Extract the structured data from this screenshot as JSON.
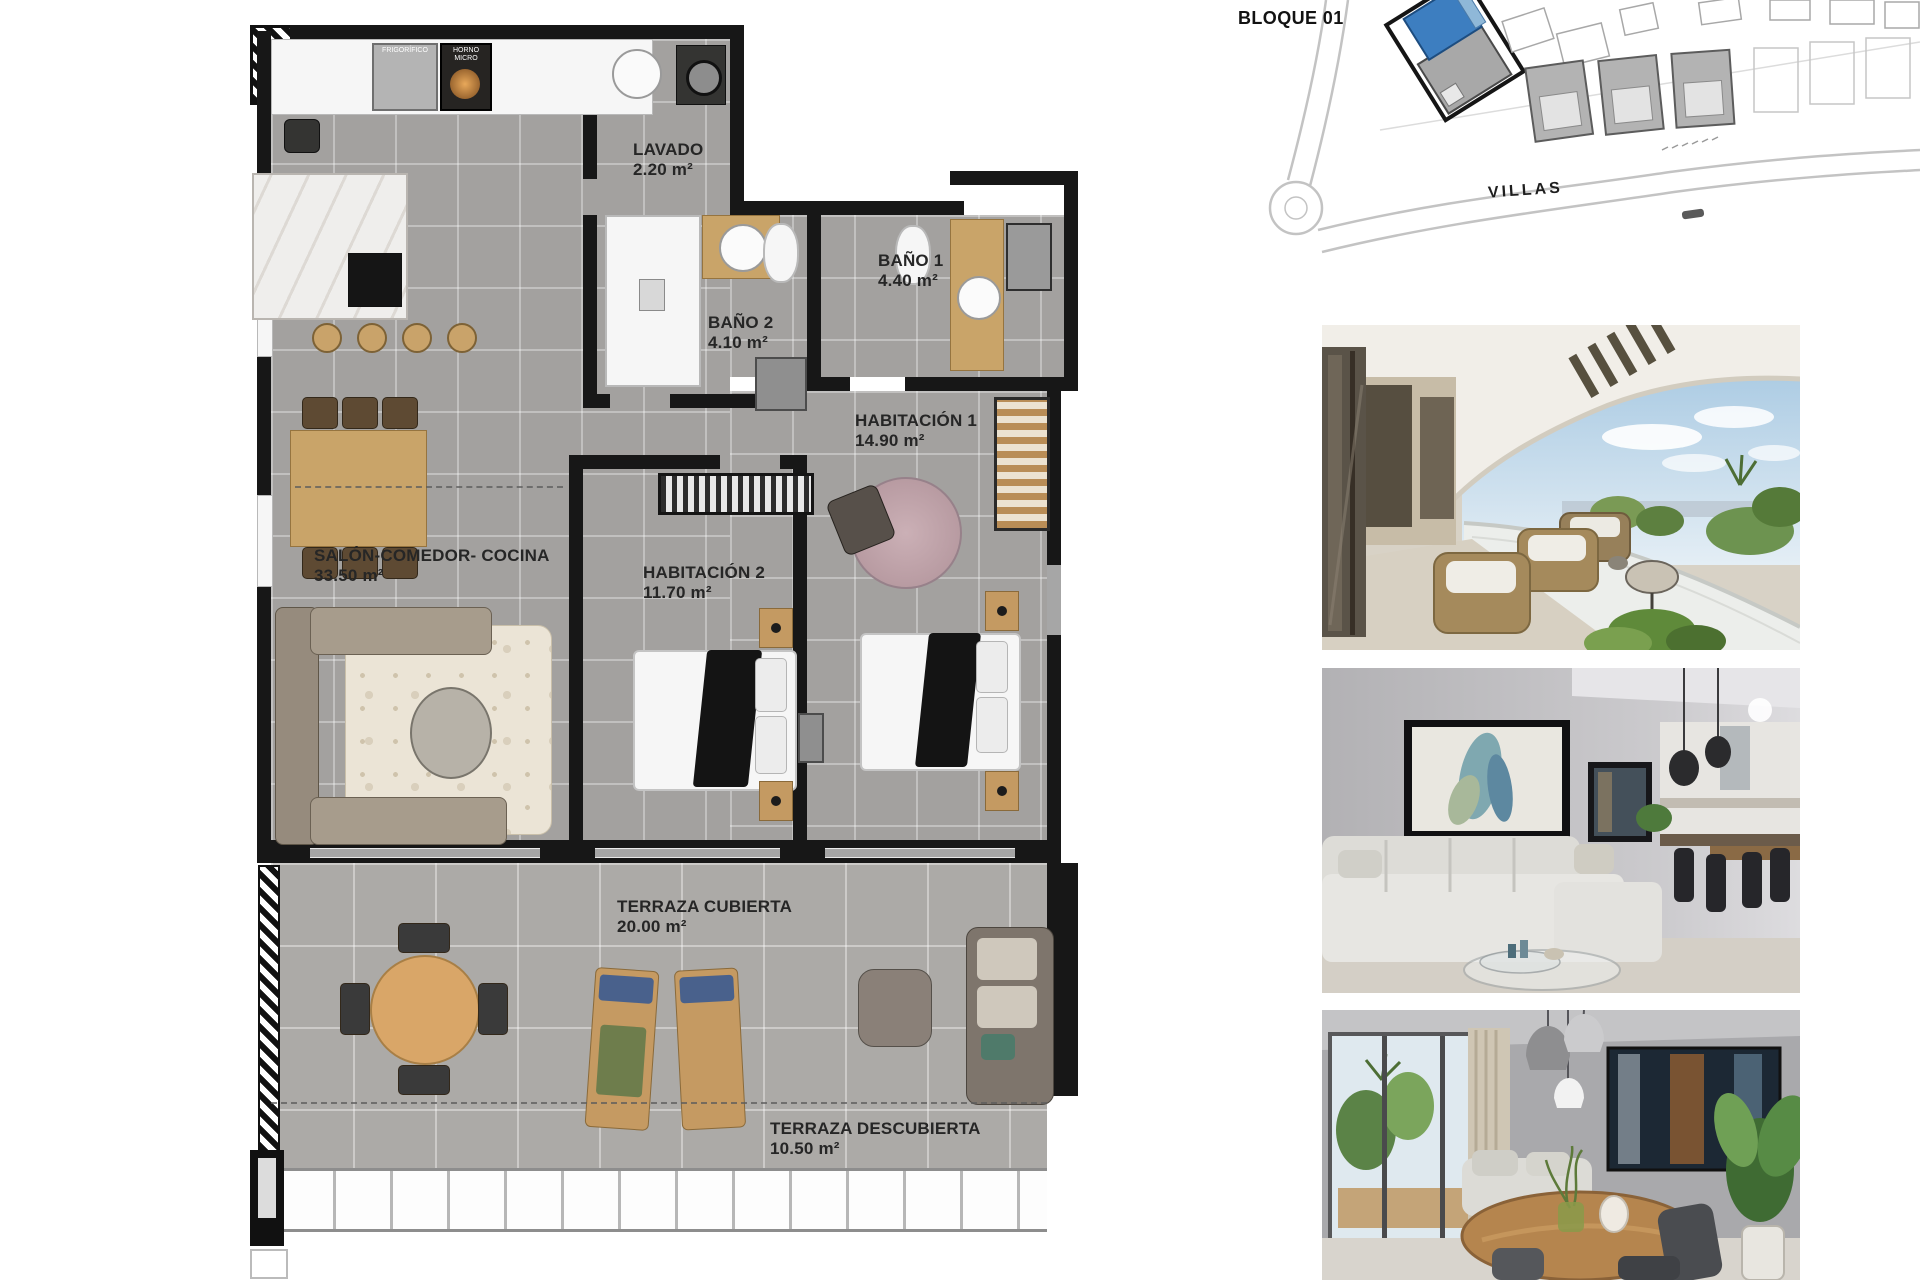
{
  "floorplan": {
    "rooms": [
      {
        "id": "lavado",
        "label": "LAVADO",
        "area": "2.20 m²"
      },
      {
        "id": "bano2",
        "label": "BAÑO 2",
        "area": "4.10 m²"
      },
      {
        "id": "bano1",
        "label": "BAÑO 1",
        "area": "4.40 m²"
      },
      {
        "id": "habitacion1",
        "label": "HABITACIÓN 1",
        "area": "14.90 m²"
      },
      {
        "id": "habitacion2",
        "label": "HABITACIÓN 2",
        "area": "11.70 m²"
      },
      {
        "id": "salon",
        "label": "SALÓN-COMEDOR- COCINA",
        "area": "33.50 m²"
      },
      {
        "id": "terraza_cubierta",
        "label": "TERRAZA CUBIERTA",
        "area": "20.00 m²"
      },
      {
        "id": "terraza_descubierta",
        "label": "TERRAZA DESCUBIERTA",
        "area": "10.50 m²"
      }
    ],
    "appliances": {
      "fridge": "FRIGORÍFICO",
      "oven": "HORNO MICRO"
    }
  },
  "site_plan": {
    "block_label": "BLOQUE 01",
    "street_label": "VILLAS",
    "highlight_color": "#3d7ec0"
  },
  "photos": [
    {
      "name": "terrace-render"
    },
    {
      "name": "living-room-render"
    },
    {
      "name": "dining-room-render"
    }
  ]
}
